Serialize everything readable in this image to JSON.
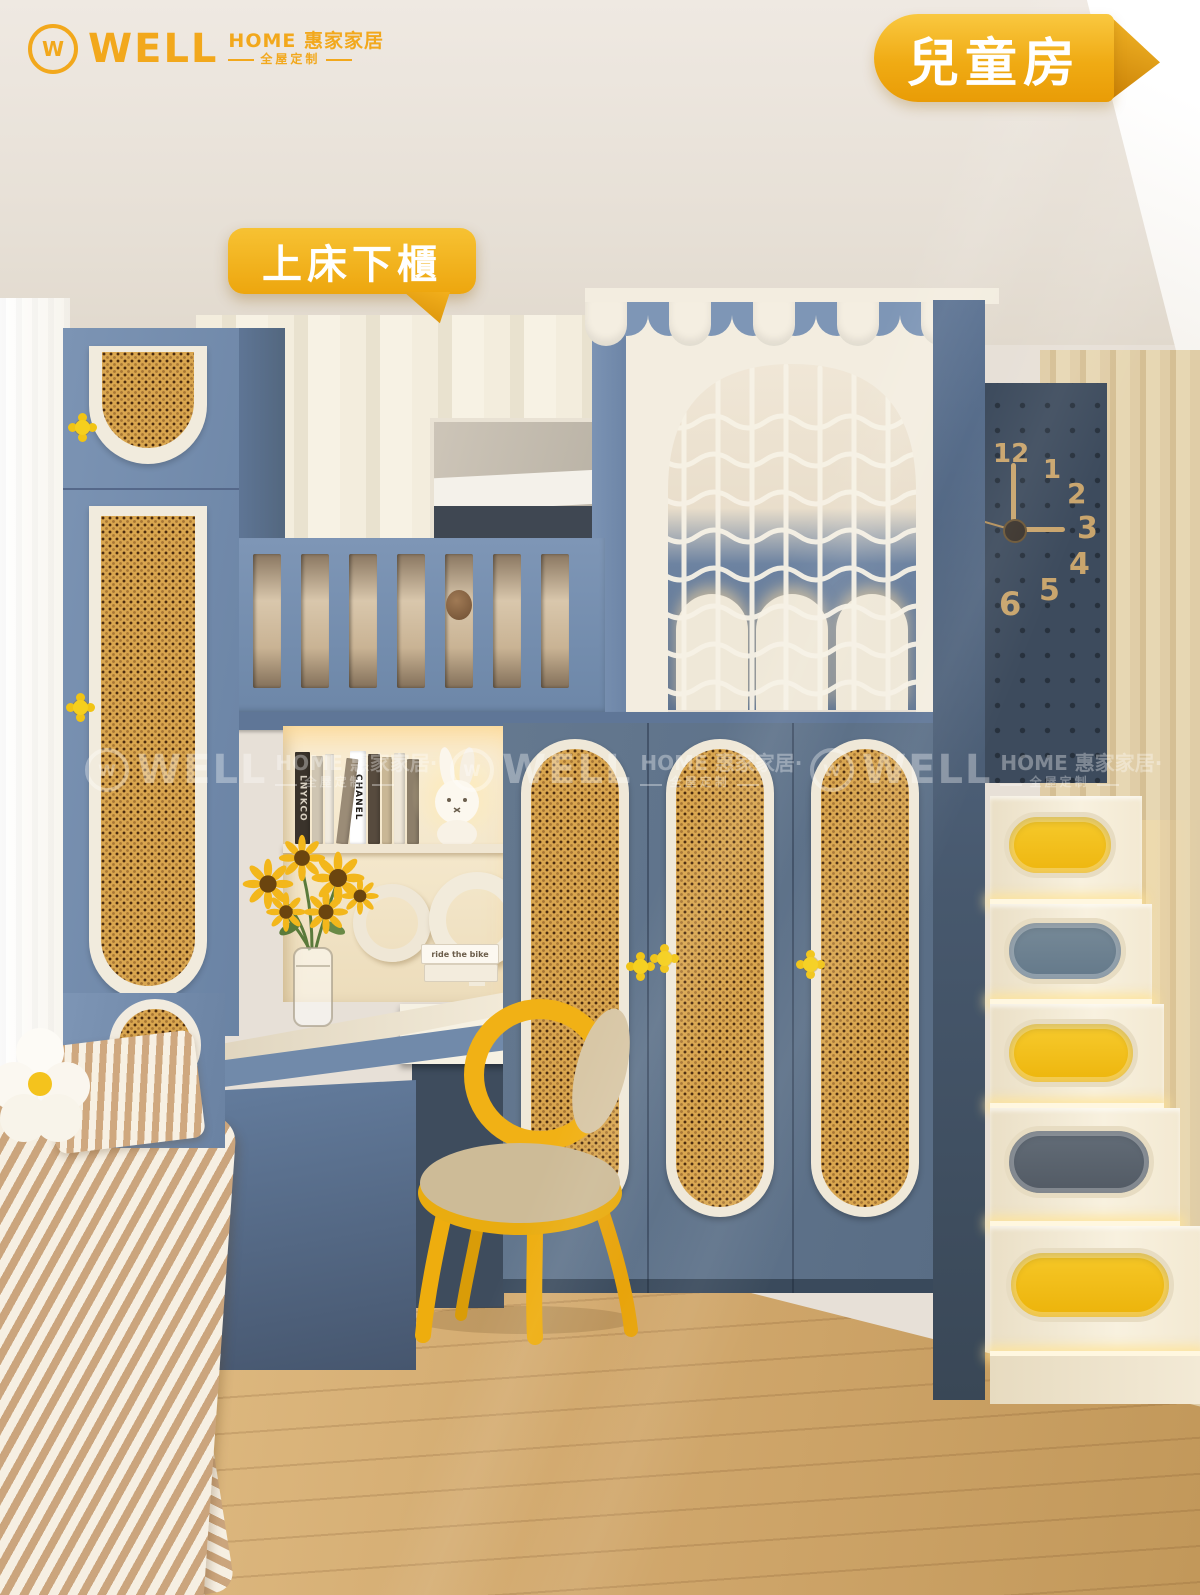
{
  "brand": {
    "name": "WELL",
    "home_line": "HOME 惠家家居",
    "tagline": "全屋定制"
  },
  "badges": {
    "room": "兒童房",
    "feature": "上床下櫃"
  },
  "watermark": {
    "name": "WELL",
    "home_line": "HOME 惠家家居·",
    "tagline": "全屋定制"
  },
  "clock": {
    "numbers": [
      "12",
      "1",
      "2",
      "3",
      "4",
      "5",
      "6"
    ]
  },
  "decor": {
    "book_spine_chanel": "CHANEL",
    "book_spine_lnykco": "LNYKCO",
    "book_cover_ride": "ride the bike"
  },
  "colors": {
    "furniture_blue": "#6B84A5",
    "furniture_blue_dark": "#46566E",
    "rattan": "#D9A64F",
    "cream": "#F2EBDC",
    "accent_yellow": "#F5B81E",
    "pegboard_navy": "#3D4B5D",
    "floor_wood": "#D2A96E",
    "wall_beige": "#E7E0D7"
  }
}
